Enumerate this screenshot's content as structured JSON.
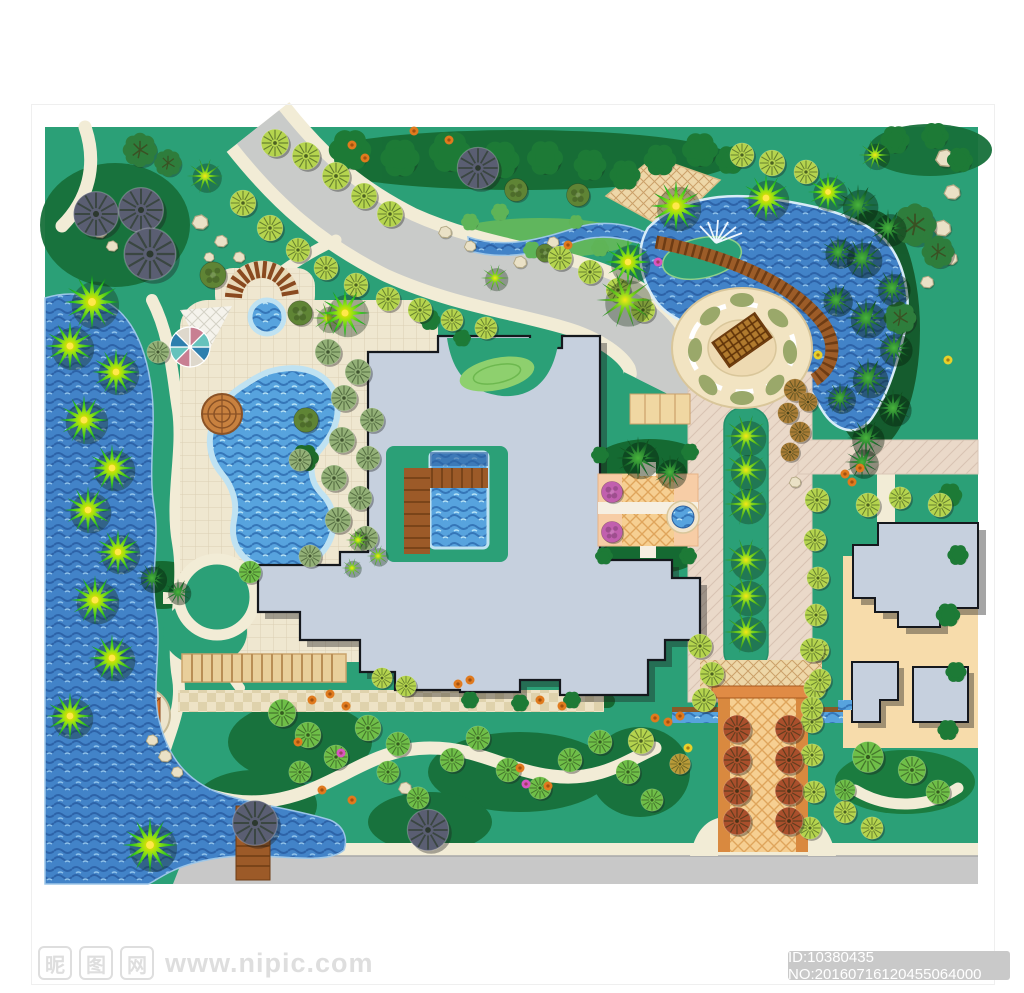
{
  "watermark": {
    "logo_chars": [
      "昵",
      "图",
      "网"
    ],
    "url_text": "www.nipic.com",
    "id_text": "ID:10380435 NO:20160716120455064000",
    "badge_bg": "#c9c9c9",
    "text_color": "#dedede"
  },
  "plan": {
    "type": "residential landscape master plan",
    "colors": {
      "lawn": "#2ba077",
      "lake_water": "#4283c8",
      "pool_water": "#57a3de",
      "road": "#c9cbc9",
      "path": "#f2ecd6",
      "plaza_paving": "#efe7d0",
      "boulevard_paving": "#ead9c9",
      "tan_paving": "#eed7a8",
      "building": "#c6d0de",
      "building_outline": "#15181d",
      "entrance_tile": "#f6cf92",
      "boardwalk": "#9c5a28",
      "red_tree": "#aa4f2c",
      "star_palm_center": "#ffdf00"
    }
  },
  "map": {
    "trees": [
      [
        "bu",
        350,
        150,
        26
      ],
      [
        "bu",
        400,
        158,
        24
      ],
      [
        "bu",
        450,
        152,
        26
      ],
      [
        "bu",
        500,
        160,
        24
      ],
      [
        "bu",
        545,
        158,
        22
      ],
      [
        "bu",
        590,
        165,
        20
      ],
      [
        "bu",
        625,
        175,
        19
      ],
      [
        "bu",
        660,
        160,
        20
      ],
      [
        "bu",
        700,
        150,
        22
      ],
      [
        "bu",
        730,
        160,
        18
      ],
      [
        "bu",
        895,
        140,
        18
      ],
      [
        "bu",
        935,
        136,
        17
      ],
      [
        "bu",
        960,
        160,
        16
      ],
      [
        "bu",
        950,
        495,
        15
      ],
      [
        "bu",
        958,
        555,
        13
      ],
      [
        "bu",
        948,
        615,
        15
      ],
      [
        "bu",
        956,
        672,
        13
      ],
      [
        "bu",
        948,
        730,
        13
      ],
      [
        "bu",
        600,
        455,
        11
      ],
      [
        "bu",
        690,
        452,
        11
      ],
      [
        "bu",
        604,
        556,
        11
      ],
      [
        "bu",
        688,
        556,
        11
      ],
      [
        "bu",
        470,
        700,
        11
      ],
      [
        "bu",
        520,
        703,
        11
      ],
      [
        "bu",
        572,
        700,
        11
      ],
      [
        "bu",
        430,
        320,
        13
      ],
      [
        "bu",
        462,
        338,
        11
      ],
      [
        "bu",
        305,
        458,
        17,
        "#1e6b2a"
      ],
      [
        "bu",
        470,
        222,
        11,
        "#5fb457"
      ],
      [
        "bu",
        500,
        212,
        11,
        "#5fb457"
      ],
      [
        "bu",
        532,
        250,
        11,
        "#5fb457"
      ],
      [
        "bu",
        600,
        248,
        11,
        "#5fb457"
      ],
      [
        "bu",
        576,
        222,
        9,
        "#5fb457"
      ],
      [
        "ff",
        140,
        150,
        20
      ],
      [
        "ff",
        168,
        163,
        16
      ],
      [
        "ff",
        915,
        225,
        25
      ],
      [
        "ff",
        938,
        252,
        19
      ],
      [
        "ff",
        900,
        318,
        19
      ],
      [
        "ms",
        213,
        275,
        16
      ],
      [
        "ms",
        300,
        313,
        15
      ],
      [
        "ms",
        516,
        190,
        14
      ],
      [
        "ms",
        578,
        195,
        14
      ],
      [
        "ms",
        545,
        253,
        11
      ],
      [
        "ms",
        306,
        420,
        15
      ],
      [
        "fo",
        158,
        352,
        13
      ],
      [
        "fo",
        328,
        352,
        15
      ],
      [
        "fo",
        358,
        372,
        15
      ],
      [
        "fo",
        344,
        398,
        15
      ],
      [
        "fo",
        372,
        420,
        14
      ],
      [
        "fo",
        342,
        440,
        15
      ],
      [
        "fo",
        368,
        458,
        14
      ],
      [
        "fo",
        334,
        478,
        15
      ],
      [
        "fo",
        360,
        498,
        14
      ],
      [
        "fo",
        338,
        520,
        15
      ],
      [
        "fo",
        366,
        538,
        14
      ],
      [
        "fo",
        310,
        556,
        13
      ],
      [
        "fo",
        300,
        460,
        13
      ],
      [
        "fg",
        96,
        214,
        26
      ],
      [
        "fg",
        141,
        210,
        26
      ],
      [
        "fg",
        150,
        254,
        30
      ],
      [
        "fg",
        478,
        168,
        24
      ],
      [
        "fg",
        255,
        823,
        26
      ],
      [
        "fg",
        428,
        830,
        24
      ],
      [
        "fy",
        275,
        143,
        16
      ],
      [
        "fy",
        306,
        156,
        16
      ],
      [
        "fy",
        336,
        176,
        16
      ],
      [
        "fy",
        364,
        196,
        15
      ],
      [
        "fy",
        390,
        214,
        15
      ],
      [
        "fy",
        243,
        203,
        15
      ],
      [
        "fy",
        270,
        228,
        15
      ],
      [
        "fy",
        298,
        250,
        14
      ],
      [
        "fy",
        326,
        268,
        14
      ],
      [
        "fy",
        356,
        285,
        14
      ],
      [
        "fy",
        388,
        299,
        14
      ],
      [
        "fy",
        420,
        310,
        14
      ],
      [
        "fy",
        452,
        320,
        13
      ],
      [
        "fy",
        486,
        328,
        13
      ],
      [
        "fy",
        560,
        258,
        14
      ],
      [
        "fy",
        590,
        272,
        14
      ],
      [
        "fy",
        618,
        290,
        14
      ],
      [
        "fy",
        643,
        310,
        14
      ],
      [
        "fy",
        742,
        155,
        14
      ],
      [
        "fy",
        772,
        163,
        15
      ],
      [
        "fy",
        806,
        172,
        14
      ],
      [
        "fy",
        817,
        500,
        14
      ],
      [
        "fy",
        815,
        540,
        13
      ],
      [
        "fy",
        818,
        578,
        13
      ],
      [
        "fy",
        816,
        615,
        13
      ],
      [
        "fy",
        818,
        650,
        13
      ],
      [
        "fy",
        815,
        688,
        13
      ],
      [
        "fy",
        812,
        722,
        13
      ],
      [
        "fy",
        812,
        755,
        13
      ],
      [
        "fy",
        814,
        792,
        13
      ],
      [
        "fy",
        810,
        828,
        13
      ],
      [
        "fy",
        868,
        505,
        14
      ],
      [
        "fy",
        900,
        498,
        13
      ],
      [
        "fy",
        940,
        505,
        14
      ],
      [
        "fy",
        641,
        741,
        15
      ],
      [
        "fy",
        700,
        646,
        14
      ],
      [
        "fy",
        712,
        674,
        14
      ],
      [
        "fy",
        704,
        700,
        14
      ],
      [
        "fy",
        812,
        650,
        14
      ],
      [
        "fy",
        820,
        680,
        13
      ],
      [
        "fy",
        812,
        708,
        13
      ],
      [
        "fy",
        845,
        812,
        13
      ],
      [
        "fy",
        872,
        828,
        13
      ],
      [
        "fy",
        382,
        678,
        12
      ],
      [
        "fy",
        406,
        686,
        12
      ],
      [
        "fm",
        282,
        713,
        16
      ],
      [
        "fm",
        308,
        735,
        15
      ],
      [
        "fm",
        336,
        757,
        14
      ],
      [
        "fm",
        300,
        772,
        13
      ],
      [
        "fm",
        368,
        728,
        15
      ],
      [
        "fm",
        398,
        744,
        14
      ],
      [
        "fm",
        388,
        772,
        13
      ],
      [
        "fm",
        418,
        798,
        13
      ],
      [
        "fm",
        452,
        760,
        14
      ],
      [
        "fm",
        478,
        738,
        14
      ],
      [
        "fm",
        508,
        770,
        14
      ],
      [
        "fm",
        540,
        788,
        13
      ],
      [
        "fm",
        570,
        760,
        14
      ],
      [
        "fm",
        600,
        742,
        14
      ],
      [
        "fm",
        628,
        772,
        14
      ],
      [
        "fm",
        652,
        800,
        13
      ],
      [
        "fm",
        250,
        572,
        13
      ],
      [
        "fm",
        868,
        757,
        18
      ],
      [
        "fm",
        912,
        770,
        16
      ],
      [
        "fm",
        938,
        792,
        14
      ],
      [
        "fm",
        845,
        790,
        12
      ],
      [
        "fb",
        795,
        390,
        13
      ],
      [
        "fb",
        788,
        413,
        12
      ],
      [
        "fb",
        800,
        432,
        12
      ],
      [
        "fb",
        790,
        452,
        11
      ],
      [
        "fb",
        808,
        402,
        11
      ],
      [
        "fb",
        680,
        764,
        12,
        "#b89a38"
      ],
      [
        "pd",
        858,
        205,
        23
      ],
      [
        "pd",
        888,
        228,
        21
      ],
      [
        "pd",
        862,
        258,
        23
      ],
      [
        "pd",
        892,
        288,
        21
      ],
      [
        "pd",
        866,
        318,
        23
      ],
      [
        "pd",
        894,
        348,
        21
      ],
      [
        "pd",
        868,
        378,
        23
      ],
      [
        "pd",
        893,
        408,
        21
      ],
      [
        "pd",
        866,
        438,
        21
      ],
      [
        "pd",
        838,
        252,
        19
      ],
      [
        "pd",
        836,
        300,
        19
      ],
      [
        "pd",
        840,
        398,
        18
      ],
      [
        "pd",
        862,
        462,
        19
      ],
      [
        "pd",
        638,
        458,
        24
      ],
      [
        "pd",
        670,
        472,
        19
      ],
      [
        "pd",
        152,
        578,
        17
      ],
      [
        "pd",
        178,
        592,
        15
      ],
      [
        "ps",
        205,
        176,
        19
      ],
      [
        "ps",
        495,
        278,
        15
      ],
      [
        "ps",
        625,
        300,
        30
      ],
      [
        "ps",
        875,
        155,
        17
      ],
      [
        "ps",
        328,
        318,
        17
      ],
      [
        "ps",
        746,
        436,
        23
      ],
      [
        "ps",
        746,
        470,
        23
      ],
      [
        "ps",
        746,
        504,
        23
      ],
      [
        "ps",
        746,
        560,
        23
      ],
      [
        "ps",
        746,
        596,
        23
      ],
      [
        "ps",
        746,
        632,
        23
      ],
      [
        "ps",
        358,
        540,
        13
      ],
      [
        "ps",
        378,
        556,
        12
      ],
      [
        "ps",
        352,
        568,
        11
      ],
      [
        "fr",
        737,
        729,
        16
      ],
      [
        "fr",
        737,
        760,
        16
      ],
      [
        "fr",
        737,
        791,
        16
      ],
      [
        "fr",
        737,
        821,
        16
      ],
      [
        "fr",
        789,
        729,
        16
      ],
      [
        "fr",
        789,
        760,
        16
      ],
      [
        "fr",
        789,
        791,
        16
      ],
      [
        "fr",
        789,
        821,
        16
      ],
      [
        "fp",
        612,
        492,
        13
      ],
      [
        "fp",
        612,
        532,
        13
      ],
      [
        "st",
        345,
        313,
        26
      ],
      [
        "st",
        628,
        262,
        24
      ],
      [
        "st",
        676,
        206,
        27
      ],
      [
        "st",
        766,
        198,
        25
      ],
      [
        "st",
        828,
        192,
        21
      ],
      [
        "st",
        92,
        302,
        29
      ],
      [
        "st",
        70,
        346,
        26
      ],
      [
        "st",
        116,
        372,
        25
      ],
      [
        "st",
        84,
        420,
        26
      ],
      [
        "st",
        112,
        468,
        25
      ],
      [
        "st",
        88,
        510,
        25
      ],
      [
        "st",
        118,
        552,
        24
      ],
      [
        "st",
        95,
        600,
        26
      ],
      [
        "st",
        112,
        658,
        25
      ],
      [
        "st",
        70,
        716,
        25
      ],
      [
        "st",
        150,
        845,
        29
      ]
    ],
    "rocks": [
      [
        200,
        222,
        11
      ],
      [
        221,
        241,
        9
      ],
      [
        239,
        257,
        8
      ],
      [
        209,
        257,
        7
      ],
      [
        100,
        232,
        9
      ],
      [
        112,
        246,
        8
      ],
      [
        445,
        232,
        9
      ],
      [
        470,
        246,
        8
      ],
      [
        520,
        262,
        9
      ],
      [
        553,
        242,
        8
      ],
      [
        945,
        158,
        13
      ],
      [
        952,
        192,
        11
      ],
      [
        942,
        228,
        12
      ],
      [
        950,
        258,
        10
      ],
      [
        927,
        282,
        9
      ],
      [
        165,
        756,
        9
      ],
      [
        177,
        772,
        8
      ],
      [
        152,
        740,
        8
      ],
      [
        795,
        482,
        8
      ],
      [
        405,
        788,
        9
      ],
      [
        385,
        776,
        8
      ]
    ],
    "flowers": [
      {
        "c": "#e07a1e",
        "pts": [
          [
            352,
            145
          ],
          [
            365,
            158
          ],
          [
            414,
            131
          ],
          [
            449,
            140
          ],
          [
            568,
            245
          ],
          [
            312,
            700
          ],
          [
            330,
            694
          ],
          [
            346,
            706
          ],
          [
            298,
            742
          ],
          [
            322,
            790
          ],
          [
            352,
            800
          ],
          [
            540,
            700
          ],
          [
            562,
            706
          ],
          [
            520,
            768
          ],
          [
            548,
            786
          ],
          [
            458,
            684
          ],
          [
            470,
            680
          ],
          [
            655,
            718
          ],
          [
            668,
            722
          ],
          [
            680,
            716
          ],
          [
            845,
            474
          ],
          [
            852,
            482
          ],
          [
            860,
            468
          ]
        ]
      },
      {
        "c": "#d955c0",
        "pts": [
          [
            341,
            753
          ],
          [
            526,
            784
          ],
          [
            658,
            262
          ]
        ]
      },
      {
        "c": "#e8d02a",
        "pts": [
          [
            818,
            355
          ],
          [
            948,
            360
          ],
          [
            688,
            748
          ]
        ]
      }
    ]
  }
}
